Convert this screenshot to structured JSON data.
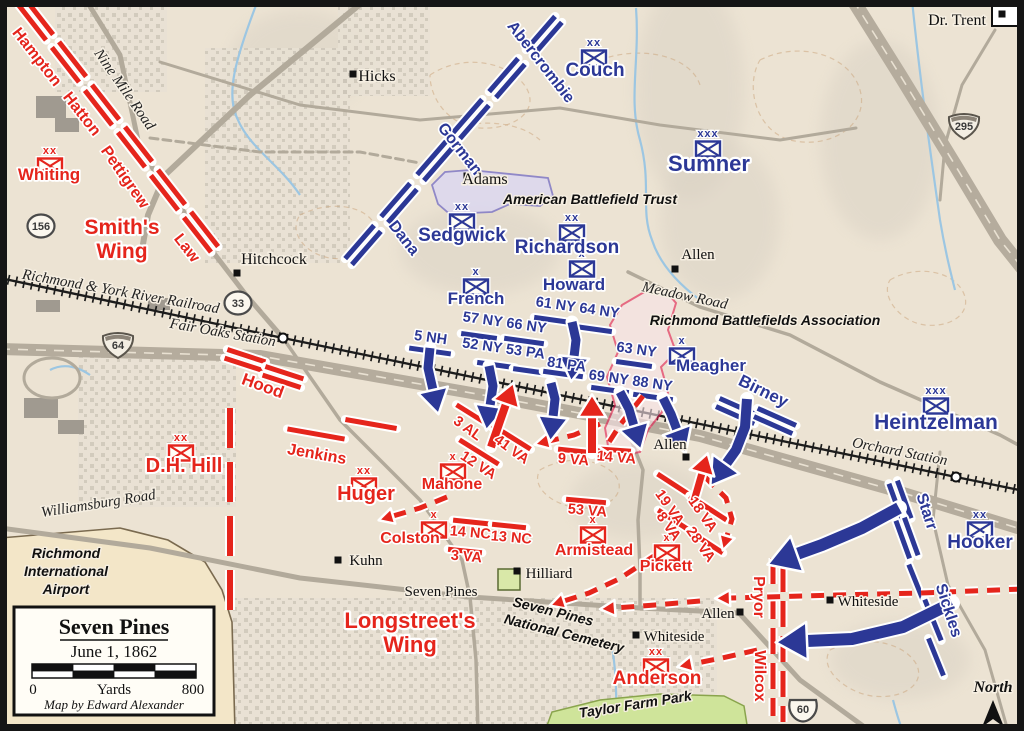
{
  "colors": {
    "csa": "#e5251c",
    "usa": "#2c3896",
    "bg": "#ece3d3",
    "water": "#9cc6e2",
    "park": "#cfe49a",
    "park_edge": "#8aa44d",
    "abt_fill": "#dcd8f0",
    "abt_edge": "#8079c6",
    "rba_fill": "#f9e3e7",
    "rba_edge": "#e31a4e",
    "road": "#b2aa9b",
    "rail": "#1c1c1c",
    "urban": "#ccc5b8",
    "airport_fill": "#f3e6c8",
    "airport_edge": "#7a6a4f",
    "halo": "#ffffff"
  },
  "labels": [
    [
      "Hampton",
      33,
      60,
      16,
      "csa",
      52
    ],
    [
      "Hatton",
      78,
      117,
      16,
      "csa",
      52
    ],
    [
      "Whiting",
      49,
      180,
      17,
      "csa",
      0
    ],
    [
      "Pettigrew",
      121,
      180,
      16,
      "csa",
      55
    ],
    [
      "Smith's",
      122,
      234,
      21,
      "csa",
      0
    ],
    [
      "Wing",
      122,
      258,
      21,
      "csa",
      0
    ],
    [
      "Law",
      183,
      251,
      16,
      "csa",
      52
    ],
    [
      "Hood",
      261,
      391,
      17,
      "csa",
      20
    ],
    [
      "Jenkins",
      316,
      459,
      16,
      "csa",
      10
    ],
    [
      "D.H. Hill",
      184,
      472,
      20,
      "csa",
      0
    ],
    [
      "Huger",
      366,
      500,
      20,
      "csa",
      0
    ],
    [
      "Mahone",
      452,
      489,
      16,
      "csa",
      0
    ],
    [
      "Colston",
      410,
      543,
      16,
      "csa",
      0
    ],
    [
      "3 AL",
      465,
      432,
      14.5,
      "csa",
      36
    ],
    [
      "41 VA",
      509,
      453,
      14.5,
      "csa",
      36
    ],
    [
      "12 VA",
      476,
      469,
      14.5,
      "csa",
      33
    ],
    [
      "9 VA",
      573,
      464,
      14.5,
      "csa",
      5
    ],
    [
      "14 VA",
      616,
      462,
      14.5,
      "csa",
      5
    ],
    [
      "53 VA",
      587,
      515,
      14.5,
      "csa",
      5
    ],
    [
      "14 NC",
      470,
      537,
      14.5,
      "csa",
      5
    ],
    [
      "13 NC",
      511,
      542,
      14.5,
      "csa",
      5
    ],
    [
      "3 VA",
      466,
      561,
      14.5,
      "csa",
      5
    ],
    [
      "Armistead",
      594,
      555,
      16,
      "csa",
      0
    ],
    [
      "Pickett",
      666,
      571,
      16,
      "csa",
      0
    ],
    [
      "19 VA",
      666,
      510,
      14.5,
      "csa",
      55
    ],
    [
      "18 VA",
      699,
      517,
      14.5,
      "csa",
      55
    ],
    [
      "8 VA",
      665,
      529,
      14.5,
      "csa",
      55
    ],
    [
      "28 VA",
      697,
      547,
      14.5,
      "csa",
      55
    ],
    [
      "Longstreet's",
      410,
      628,
      22,
      "csa",
      0
    ],
    [
      "Wing",
      410,
      652,
      22,
      "csa",
      0
    ],
    [
      "Anderson",
      657,
      684,
      19,
      "csa",
      0
    ],
    [
      "Pryor",
      754,
      597,
      16,
      "csa",
      90
    ],
    [
      "Wilcox",
      755,
      676,
      16,
      "csa",
      90
    ],
    [
      "Abercrombie",
      537,
      65,
      16,
      "usa",
      52
    ],
    [
      "Couch",
      595,
      76,
      19,
      "usa",
      0
    ],
    [
      "Gorman",
      456,
      152,
      16,
      "usa",
      52
    ],
    [
      "Sumner",
      709,
      171,
      22,
      "usa",
      0
    ],
    [
      "Dana",
      400,
      241,
      16,
      "usa",
      52
    ],
    [
      "Sedgwick",
      462,
      241,
      19,
      "usa",
      0
    ],
    [
      "Richardson",
      567,
      253,
      19,
      "usa",
      0
    ],
    [
      "French",
      476,
      304,
      17,
      "usa",
      0
    ],
    [
      "Howard",
      574,
      290,
      17,
      "usa",
      0
    ],
    [
      "61 NY 64 NY",
      577,
      312,
      14.5,
      "usa",
      8
    ],
    [
      "57 NY 66 NY",
      504,
      327,
      14.5,
      "usa",
      8
    ],
    [
      "5 NH",
      430,
      342,
      14.5,
      "usa",
      8
    ],
    [
      "52 NY 53 PA",
      503,
      353,
      14.5,
      "usa",
      8
    ],
    [
      "81 PA",
      566,
      369,
      14.5,
      "usa",
      8
    ],
    [
      "63 NY",
      636,
      354,
      14.5,
      "usa",
      8
    ],
    [
      "69 NY 88 NY",
      630,
      385,
      14.5,
      "usa",
      8
    ],
    [
      "Meagher",
      711,
      371,
      17,
      "usa",
      0
    ],
    [
      "Birney",
      761,
      396,
      17,
      "usa",
      26
    ],
    [
      "Heintzelman",
      936,
      429,
      21,
      "usa",
      0
    ],
    [
      "Starr",
      922,
      513,
      16,
      "usa",
      72
    ],
    [
      "Hooker",
      980,
      548,
      19,
      "usa",
      0
    ],
    [
      "Sickles",
      944,
      612,
      16,
      "usa",
      72
    ],
    [
      "Hicks",
      377,
      81,
      16,
      "plc",
      0
    ],
    [
      "Adams",
      485,
      184,
      16,
      "plc",
      0
    ],
    [
      "Hitchcock",
      274,
      264,
      16,
      "plc",
      0
    ],
    [
      "Dr. Trent",
      957,
      25,
      16,
      "plc",
      0
    ],
    [
      "Allen",
      698,
      259,
      15,
      "plc",
      0
    ],
    [
      "Allen",
      670,
      449,
      15,
      "plc",
      0
    ],
    [
      "Allen",
      718,
      618,
      15,
      "plc",
      0
    ],
    [
      "Kuhn",
      366,
      565,
      15,
      "plc",
      0
    ],
    [
      "Hilliard",
      549,
      578,
      15,
      "plc",
      0
    ],
    [
      "Whiteside",
      868,
      606,
      15,
      "plc",
      0
    ],
    [
      "Whiteside",
      674,
      641,
      15,
      "plc",
      0
    ],
    [
      "Seven Pines",
      441,
      596,
      15,
      "plc",
      0
    ],
    [
      "Nine Mile Road",
      121,
      92,
      15,
      "rd",
      55
    ],
    [
      "Richmond & York River Railroad",
      120,
      296,
      15,
      "rd",
      10
    ],
    [
      "Fair Oaks Station",
      222,
      337,
      15,
      "rd",
      10
    ],
    [
      "Meadow Road",
      684,
      300,
      15,
      "rd",
      12
    ],
    [
      "Orchard Station",
      899,
      456,
      15,
      "rd",
      11
    ],
    [
      "Williamsburg Road",
      99,
      508,
      15,
      "rd",
      -9
    ],
    [
      "American Battlefield Trust",
      590,
      204,
      14,
      "poi",
      0
    ],
    [
      "Richmond Battlefields Association",
      765,
      325,
      14,
      "poi",
      0
    ],
    [
      "Richmond",
      66,
      558,
      14,
      "poi",
      0
    ],
    [
      "International",
      66,
      576,
      14,
      "poi",
      0
    ],
    [
      "Airport",
      66,
      594,
      14,
      "poi",
      0
    ],
    [
      "Seven Pines",
      552,
      616,
      14,
      "poi",
      14
    ],
    [
      "National Cemetery",
      563,
      638,
      14,
      "poi",
      14
    ],
    [
      "Taylor Farm Park",
      636,
      709,
      14,
      "poi",
      -9
    ],
    [
      "North",
      993,
      692,
      16,
      "north",
      0
    ]
  ],
  "bars": [
    [
      "c",
      36,
      20,
      44,
      52,
      2
    ],
    [
      "c",
      69,
      62,
      44,
      52,
      2
    ],
    [
      "c",
      102,
      105,
      44,
      52,
      2
    ],
    [
      "c",
      135,
      147,
      44,
      52,
      2
    ],
    [
      "c",
      168,
      190,
      44,
      52,
      2
    ],
    [
      "c",
      201,
      232,
      44,
      52,
      2
    ],
    [
      "c",
      245,
      360,
      40,
      18,
      2
    ],
    [
      "c",
      283,
      377,
      40,
      18,
      2
    ],
    [
      "c",
      316,
      434,
      58,
      10,
      1
    ],
    [
      "c",
      371,
      424,
      52,
      10,
      1
    ],
    [
      "c",
      476,
      417,
      46,
      32,
      1
    ],
    [
      "c",
      511,
      437,
      46,
      32,
      1
    ],
    [
      "c",
      479,
      452,
      46,
      32,
      1
    ],
    [
      "c",
      576,
      451,
      36,
      6,
      1
    ],
    [
      "c",
      614,
      450,
      34,
      4,
      1
    ],
    [
      "c",
      586,
      501,
      40,
      5,
      1
    ],
    [
      "c",
      471,
      522,
      36,
      6,
      1
    ],
    [
      "c",
      509,
      526,
      34,
      6,
      1
    ],
    [
      "c",
      465,
      551,
      34,
      6,
      1
    ],
    [
      "c",
      676,
      486,
      44,
      33,
      1
    ],
    [
      "c",
      708,
      508,
      44,
      33,
      1
    ],
    [
      "c",
      675,
      521,
      40,
      33,
      1
    ],
    [
      "c",
      706,
      542,
      40,
      33,
      1
    ],
    [
      "u",
      363,
      245,
      44,
      -49,
      2
    ],
    [
      "u",
      399,
      203,
      44,
      -49,
      2
    ],
    [
      "u",
      435,
      161,
      44,
      -49,
      2
    ],
    [
      "u",
      471,
      119,
      44,
      -49,
      2
    ],
    [
      "u",
      507,
      78,
      44,
      -49,
      2
    ],
    [
      "u",
      544,
      36,
      44,
      -49,
      2
    ],
    [
      "u",
      430,
      351,
      42,
      8,
      1
    ],
    [
      "u",
      479,
      336,
      36,
      8,
      1
    ],
    [
      "u",
      524,
      341,
      40,
      8,
      1
    ],
    [
      "u",
      553,
      320,
      38,
      8,
      1
    ],
    [
      "u",
      593,
      329,
      38,
      8,
      1
    ],
    [
      "u",
      496,
      365,
      38,
      8,
      1
    ],
    [
      "u",
      530,
      371,
      34,
      8,
      1
    ],
    [
      "u",
      563,
      374,
      40,
      8,
      1
    ],
    [
      "u",
      634,
      364,
      36,
      8,
      1
    ],
    [
      "u",
      610,
      390,
      38,
      8,
      1
    ],
    [
      "u",
      653,
      397,
      40,
      8,
      1
    ],
    [
      "u",
      737,
      411,
      42,
      24,
      2
    ],
    [
      "u",
      775,
      421,
      42,
      24,
      2
    ],
    [
      "u",
      900,
      501,
      40,
      70,
      2
    ],
    [
      "u",
      907,
      538,
      40,
      70,
      2
    ],
    [
      "u",
      917,
      585,
      44,
      68,
      1
    ],
    [
      "u",
      933,
      620,
      44,
      68,
      1
    ],
    [
      "u",
      936,
      657,
      40,
      68,
      1
    ]
  ],
  "symbols": [
    [
      "c",
      50,
      166,
      "xx"
    ],
    [
      "c",
      181,
      453,
      "xx"
    ],
    [
      "c",
      364,
      486,
      "xx"
    ],
    [
      "c",
      453,
      472,
      "x"
    ],
    [
      "c",
      434,
      530,
      "x"
    ],
    [
      "c",
      593,
      535,
      "x"
    ],
    [
      "c",
      667,
      553,
      "x"
    ],
    [
      "c",
      656,
      667,
      "xx"
    ],
    [
      "u",
      594,
      58,
      "xx"
    ],
    [
      "u",
      708,
      149,
      "xxx"
    ],
    [
      "u",
      462,
      222,
      "xx"
    ],
    [
      "u",
      572,
      233,
      "xx"
    ],
    [
      "u",
      476,
      287,
      "x"
    ],
    [
      "u",
      582,
      269,
      "x"
    ],
    [
      "u",
      682,
      356,
      "x"
    ],
    [
      "u",
      936,
      406,
      "xxx"
    ],
    [
      "u",
      980,
      530,
      "xx"
    ]
  ],
  "dash_lines": [
    {
      "x": 230,
      "y1": 408,
      "y2": 612,
      "w": 6,
      "dash": "40 14"
    },
    {
      "x": 773,
      "y1": 558,
      "y2": 716,
      "w": 5,
      "dash": "26 9"
    },
    {
      "x": 783,
      "y1": 566,
      "y2": 722,
      "w": 5,
      "dash": "26 9"
    }
  ],
  "arrows": {
    "solid": [
      {
        "s": "u",
        "w": 9,
        "p": [
          [
            430,
            348
          ],
          [
            428,
            368
          ],
          [
            433,
            390
          ]
        ]
      },
      {
        "s": "u",
        "w": 9,
        "p": [
          [
            489,
            366
          ],
          [
            493,
            386
          ],
          [
            490,
            406
          ]
        ]
      },
      {
        "s": "u",
        "w": 9,
        "p": [
          [
            551,
            383
          ],
          [
            555,
            399
          ],
          [
            553,
            417
          ]
        ]
      },
      {
        "s": "u",
        "w": 9,
        "p": [
          [
            572,
            322
          ],
          [
            576,
            340
          ],
          [
            574,
            357
          ]
        ]
      },
      {
        "s": "u",
        "w": 9,
        "p": [
          [
            620,
            392
          ],
          [
            629,
            409
          ],
          [
            634,
            426
          ]
        ]
      },
      {
        "s": "u",
        "w": 9,
        "p": [
          [
            663,
            398
          ],
          [
            671,
            414
          ],
          [
            677,
            430
          ]
        ]
      },
      {
        "s": "u",
        "w": 10,
        "p": [
          [
            747,
            399
          ],
          [
            745,
            427
          ],
          [
            736,
            450
          ],
          [
            726,
            464
          ]
        ]
      },
      {
        "s": "u",
        "w": 12,
        "p": [
          [
            899,
            508
          ],
          [
            862,
            528
          ],
          [
            822,
            545
          ],
          [
            797,
            554
          ]
        ]
      },
      {
        "s": "u",
        "w": 12,
        "p": [
          [
            952,
            603
          ],
          [
            903,
            627
          ],
          [
            852,
            639
          ],
          [
            807,
            641
          ]
        ]
      },
      {
        "s": "c",
        "w": 8,
        "p": [
          [
            491,
            447
          ],
          [
            499,
            424
          ],
          [
            506,
            404
          ]
        ]
      },
      {
        "s": "c",
        "w": 8,
        "p": [
          [
            592,
            453
          ],
          [
            592,
            417
          ]
        ]
      },
      {
        "s": "c",
        "w": 7,
        "p": [
          [
            694,
            501
          ],
          [
            702,
            473
          ]
        ]
      }
    ],
    "dashed": [
      {
        "s": "c",
        "w": 5,
        "p": [
          [
            643,
            396
          ],
          [
            620,
            425
          ],
          [
            604,
            450
          ]
        ]
      },
      {
        "s": "c",
        "w": 5,
        "p": [
          [
            600,
            424
          ],
          [
            574,
            435
          ],
          [
            549,
            441
          ]
        ]
      },
      {
        "s": "c",
        "w": 5,
        "p": [
          [
            447,
            497
          ],
          [
            420,
            508
          ],
          [
            393,
            516
          ]
        ]
      },
      {
        "s": "c",
        "w": 5,
        "p": [
          [
            705,
            477
          ],
          [
            726,
            498
          ],
          [
            732,
            519
          ],
          [
            727,
            536
          ]
        ]
      },
      {
        "s": "c",
        "w": 5,
        "p": [
          [
            1022,
            589
          ],
          [
            920,
            593
          ],
          [
            836,
            595
          ],
          [
            730,
            598
          ]
        ]
      },
      {
        "s": "c",
        "w": 5,
        "p": [
          [
            700,
            601
          ],
          [
            655,
            605
          ],
          [
            615,
            608
          ]
        ]
      },
      {
        "s": "c",
        "w": 5,
        "p": [
          [
            654,
            556
          ],
          [
            619,
            579
          ],
          [
            589,
            593
          ],
          [
            564,
            601
          ]
        ]
      },
      {
        "s": "c",
        "w": 5,
        "p": [
          [
            757,
            650
          ],
          [
            722,
            658
          ],
          [
            692,
            664
          ]
        ]
      }
    ]
  },
  "shields": [
    {
      "k": "c",
      "n": "156",
      "x": 41,
      "y": 226
    },
    {
      "k": "c",
      "n": "33",
      "x": 238,
      "y": 303
    },
    {
      "k": "i",
      "n": "64",
      "x": 118,
      "y": 345
    },
    {
      "k": "i",
      "n": "295",
      "x": 964,
      "y": 126
    },
    {
      "k": "u",
      "n": "60",
      "x": 803,
      "y": 709
    }
  ],
  "stations": [
    [
      283,
      338
    ],
    [
      956,
      477
    ]
  ],
  "marks": [
    [
      353,
      74
    ],
    [
      467,
      176
    ],
    [
      237,
      273
    ],
    [
      1002,
      14
    ],
    [
      675,
      269
    ],
    [
      686,
      457
    ],
    [
      740,
      612
    ],
    [
      338,
      560
    ],
    [
      517,
      571
    ],
    [
      830,
      600
    ],
    [
      636,
      635
    ]
  ],
  "legend": {
    "title": "Seven Pines",
    "date": "June 1, 1862",
    "scale_start": "0",
    "scale_unit": "Yards",
    "scale_end": "800",
    "credit": "Map by Edward Alexander"
  },
  "north_label": "North"
}
